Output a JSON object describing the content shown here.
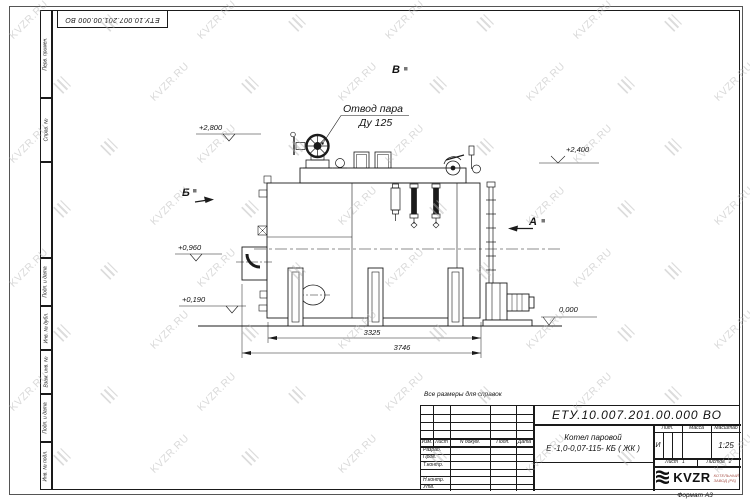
{
  "sheet": {
    "note": "Все размеры для справок",
    "format": "Формат А3"
  },
  "top_stamp": {
    "doc_number": "ЕТУ.10.007.201.00.000  ВО"
  },
  "margin_labels": [
    "Перв. примен.",
    "Справ. №",
    "Подп. и дата",
    "Инв. № дубл.",
    "Взам. инв. №",
    "Подп. и дата",
    "Инв. № подл."
  ],
  "watermark": {
    "text": "KVZR.RU",
    "color": "#b4b4b4"
  },
  "drawing": {
    "steam_outlet": {
      "line1": "Отвод пара",
      "line2": "Ду 125"
    },
    "levels": {
      "l2800": "+2,800",
      "l2400": "+2,400",
      "l0960": "+0,960",
      "l0190": "+0,190",
      "l0000": "0,000"
    },
    "views": {
      "b": "Б",
      "v": "В",
      "a": "А"
    },
    "dims": {
      "d1": "3325",
      "d2": "3746"
    }
  },
  "title_block": {
    "doc_number": "ЕТУ.10.007.201.00.000  ВО",
    "product_name_line1": "Котел паровой",
    "product_name_line2": "Е -1,0-0,07-115- КБ ( ЖК )",
    "rev_header": {
      "izm": "Изм.",
      "list": "Лист",
      "doc": "N докум.",
      "sign": "Подп.",
      "date": "Дата"
    },
    "roles": {
      "r1": "Разраб.",
      "r2": "Пров.",
      "r3": "Т.контр.",
      "r4": "Н.контр.",
      "r5": "Утв."
    },
    "lit": {
      "label": "Лит.",
      "value": "И"
    },
    "mass_label": "Масса",
    "scale": {
      "label": "Масштаб",
      "value": "1:25"
    },
    "sheet": {
      "label": "Лист",
      "value": "1",
      "of_label": "Листов",
      "of_value": "2"
    },
    "brand": {
      "name": "KVZR",
      "sub1": "КОТЕЛЬНЫЙ",
      "sub2": "ЗАВОД (РБ)"
    }
  }
}
